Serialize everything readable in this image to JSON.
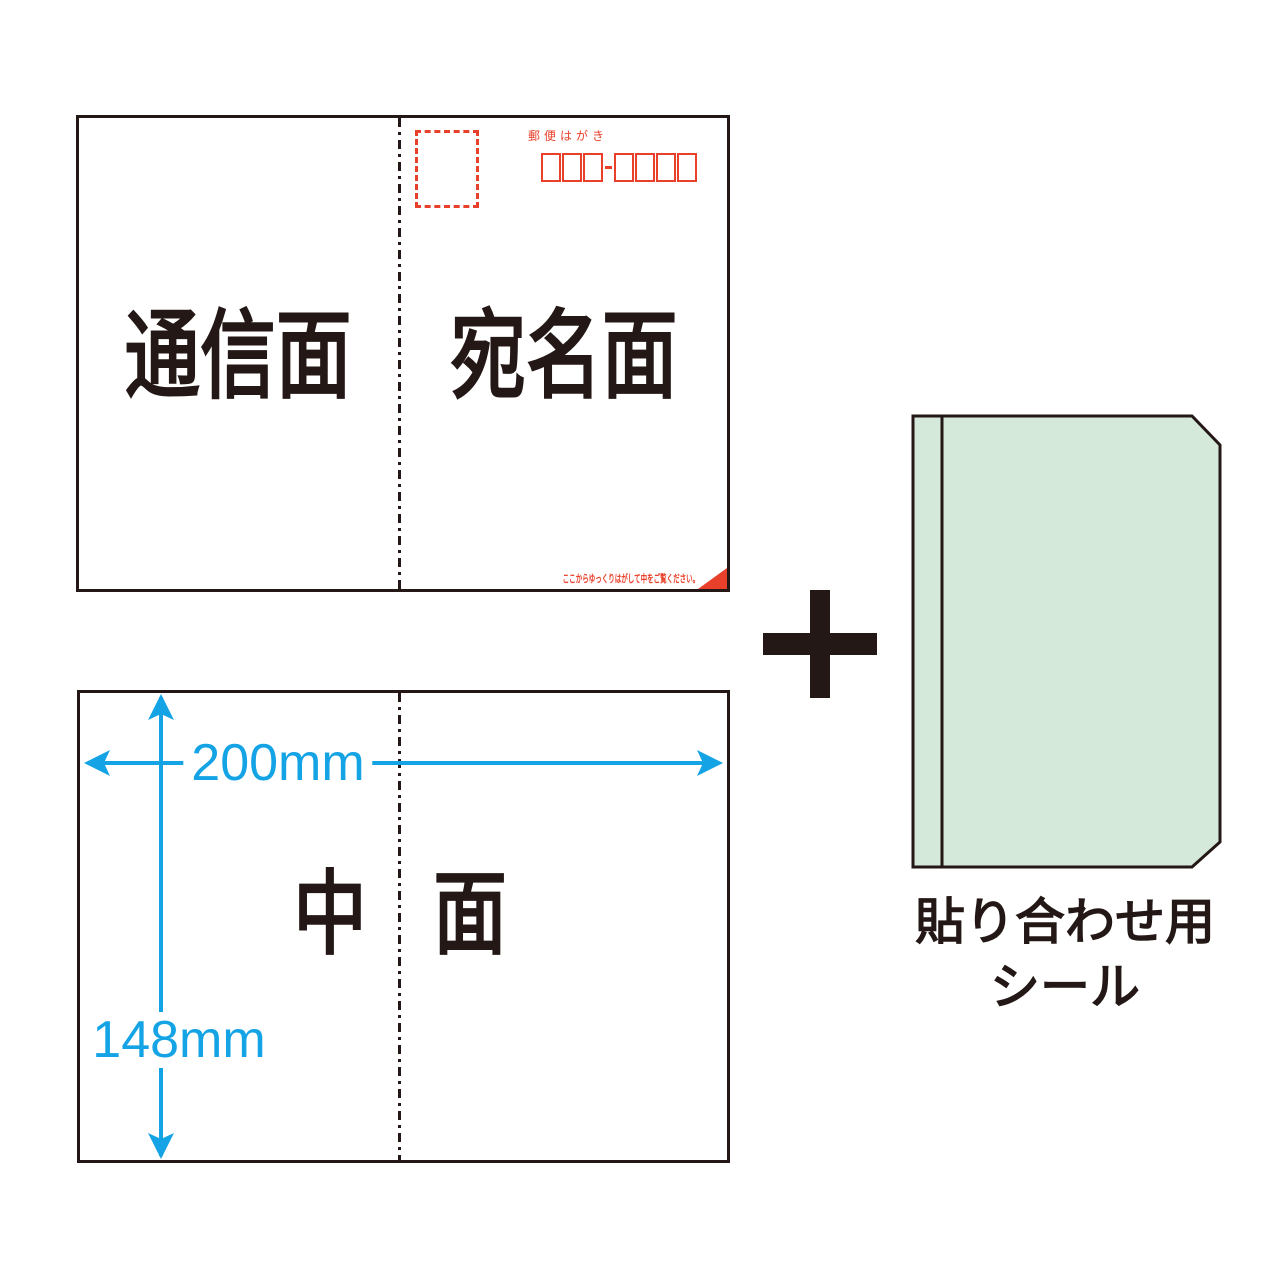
{
  "colors": {
    "ink": "#231815",
    "red": "#e8402a",
    "blue": "#14a3e4",
    "seal_green": "#d5e9db"
  },
  "postcard_top": {
    "left_label": "通信面",
    "right_label": "宛名面",
    "postmark": "郵便はがき",
    "postal_code_groups": [
      3,
      4
    ],
    "peel_note": "ここからゆっくりはがして中をご覧ください。"
  },
  "inner_sheet": {
    "left_char": "中",
    "right_char": "面",
    "width_label": "200mm",
    "height_label": "148mm"
  },
  "seal": {
    "caption_line1": "貼り合わせ用",
    "caption_line2": "シール"
  }
}
